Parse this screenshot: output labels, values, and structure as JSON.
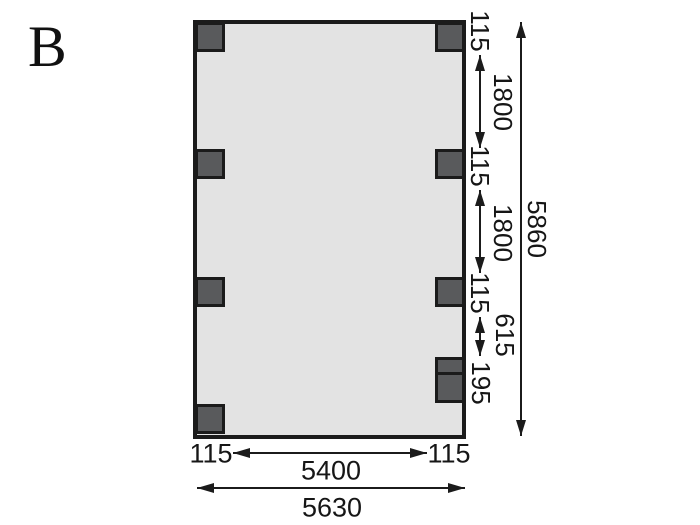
{
  "figure_label": "B",
  "colors": {
    "background": "#ffffff",
    "plan_fill": "#e3e3e3",
    "post_fill": "#595a5c",
    "line": "#1b1b1b"
  },
  "dims": {
    "right_chain": [
      "115",
      "1800",
      "115",
      "1800",
      "115",
      "615",
      "195"
    ],
    "total_height": "5860",
    "bottom_chain": [
      "115",
      "5400",
      "115"
    ],
    "total_width": "5630"
  }
}
